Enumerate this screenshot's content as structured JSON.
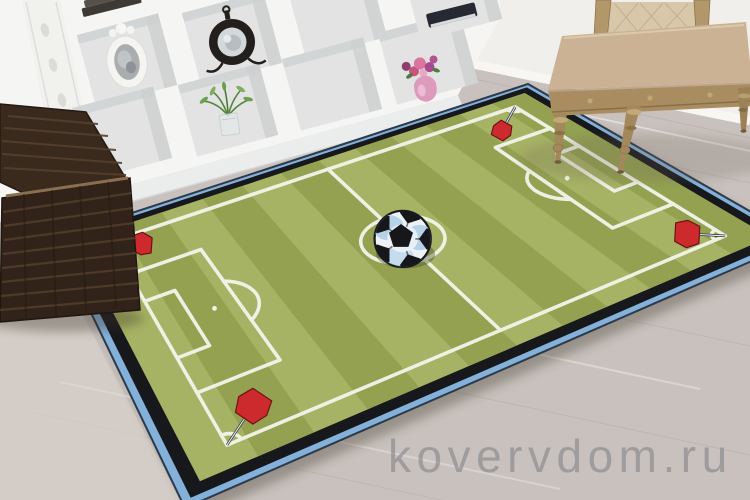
{
  "watermark": {
    "text": "kovervdom.ru"
  },
  "scene": {
    "description": "Children's soccer-field rug lying on a light laminate floor in a room with white shelving, a wicker basket and a classic chair",
    "room": {
      "wall_color": "#f1efeb",
      "floor_color": "#c8c1bd",
      "skirting_color": "#f7f6f2",
      "objects": [
        {
          "name": "white-shelving-unit"
        },
        {
          "name": "oval-photo-frame"
        },
        {
          "name": "vintage-table-clock"
        },
        {
          "name": "green-plant-in-glass-vase"
        },
        {
          "name": "stack-of-books"
        },
        {
          "name": "dark-blue-book"
        },
        {
          "name": "pink-vase-with-flowers"
        },
        {
          "name": "brown-wicker-basket"
        },
        {
          "name": "beige-upholstered-chair"
        }
      ]
    },
    "rug": {
      "design": "soccer-football-field",
      "colors": {
        "stripe_light": "#a6b264",
        "stripe_dark": "#93a151",
        "line_white": "#f2f5ea",
        "border_black": "#17181c",
        "edge_blue": "#84b1da",
        "edge_trim_navy": "#2c3a4c",
        "flag_red": "#cd2a2d",
        "flag_dark": "#6b1414",
        "ball_white": "#edf2f7",
        "ball_blue": "#b5d2e8",
        "ball_black": "#16171b"
      },
      "elements": [
        "pitch-boundary",
        "halfway-line",
        "center-circle",
        "soccer-ball",
        "penalty-areas",
        "goal-areas",
        "penalty-arcs",
        "penalty-spots",
        "corner-arcs",
        "corner-flags-red"
      ]
    }
  }
}
